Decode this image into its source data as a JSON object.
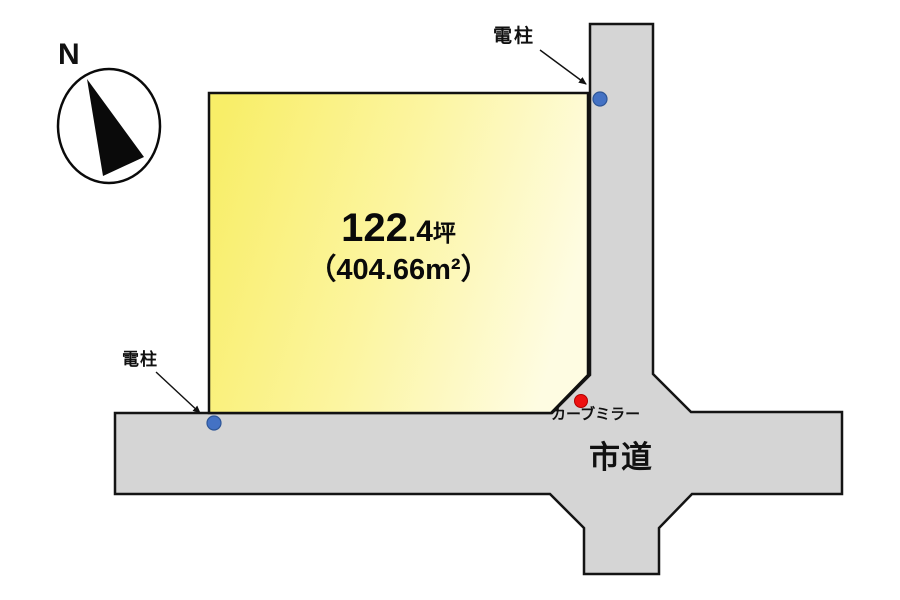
{
  "compass": {
    "north_label": "N"
  },
  "land_plot": {
    "tsubo_int": "122",
    "tsubo_frac": ".4",
    "tsubo_unit": "坪",
    "area_m2": "（404.66m²）",
    "fill_gradient": {
      "start": "#F8EE68",
      "mid": "#FCF5A0",
      "end": "#FEFCE2"
    },
    "border_color": "#111111"
  },
  "road": {
    "label": "市道",
    "fill": "#D5D5D5",
    "border_color": "#141414"
  },
  "markers": {
    "utility_pole_top": {
      "label": "電柱",
      "dot_color": "#4472C4",
      "dot_border": "#2E5697"
    },
    "utility_pole_bottom": {
      "label": "電柱",
      "dot_color": "#4472C4",
      "dot_border": "#2E5697"
    },
    "curve_mirror": {
      "label": "カーブミラー",
      "dot_color": "#EE1111",
      "dot_border": "#B00000"
    }
  }
}
